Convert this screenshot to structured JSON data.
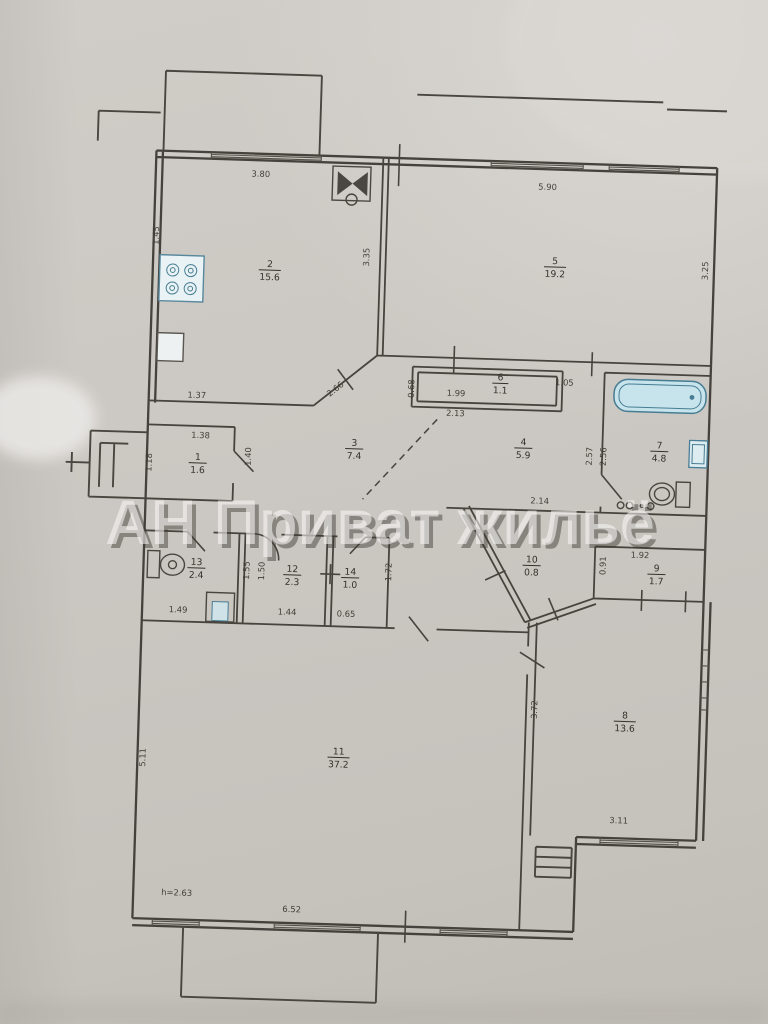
{
  "watermark": {
    "text": "АН Приват жильё"
  },
  "notes": {
    "ceiling_height": "h=2.63"
  },
  "rooms": {
    "r1": {
      "num": "1",
      "area": "1.6"
    },
    "r2": {
      "num": "2",
      "area": "15.6"
    },
    "r3": {
      "num": "3",
      "area": "7.4"
    },
    "r4": {
      "num": "4",
      "area": "5.9"
    },
    "r5": {
      "num": "5",
      "area": "19.2"
    },
    "r6": {
      "num": "6",
      "area": "1.1"
    },
    "r7": {
      "num": "7",
      "area": "4.8"
    },
    "r8": {
      "num": "8",
      "area": "13.6"
    },
    "r9": {
      "num": "9",
      "area": "1.7"
    },
    "r10": {
      "num": "10",
      "area": "0.8"
    },
    "r11": {
      "num": "11",
      "area": "37.2"
    },
    "r12": {
      "num": "12",
      "area": "2.3"
    },
    "r13": {
      "num": "13",
      "area": "2.4"
    },
    "r14": {
      "num": "14",
      "area": "1.0"
    }
  },
  "dims": {
    "kitchen_top": "3.80",
    "kitchen_left": "1.45",
    "kitchen_right": "3.35",
    "kitchen_bottom": "1.37",
    "kitchen_diag": "2.66",
    "room5_top": "5.90",
    "room5_right": "3.25",
    "room6_width": "1.99",
    "room6_width2": "2.13",
    "room6_left": "0.68",
    "room6_right": "1.05",
    "hall4_width": "2.14",
    "bath_left_a": "2.57",
    "bath_left_b": "2.56",
    "room1_top": "1.38",
    "room1_left": "1.18",
    "room1_right": "1.40",
    "wc13_bottom": "1.49",
    "wc13_right_a": "1.55",
    "wc13_right_b": "1.50",
    "room12_bottom": "1.44",
    "room14_bottom": "0.65",
    "room14_right": "1.72",
    "room9_top": "1.92",
    "room9_left": "0.91",
    "room8_left": "3.72",
    "room8_bottom": "3.11",
    "room11_left": "5.11",
    "room11_bottom": "6.52"
  },
  "colors": {
    "paper": "#cbc7c2",
    "ink": "#44403a",
    "fixture_blue": "#c7e4ec",
    "watermark_fill": "#f6f5f2"
  }
}
